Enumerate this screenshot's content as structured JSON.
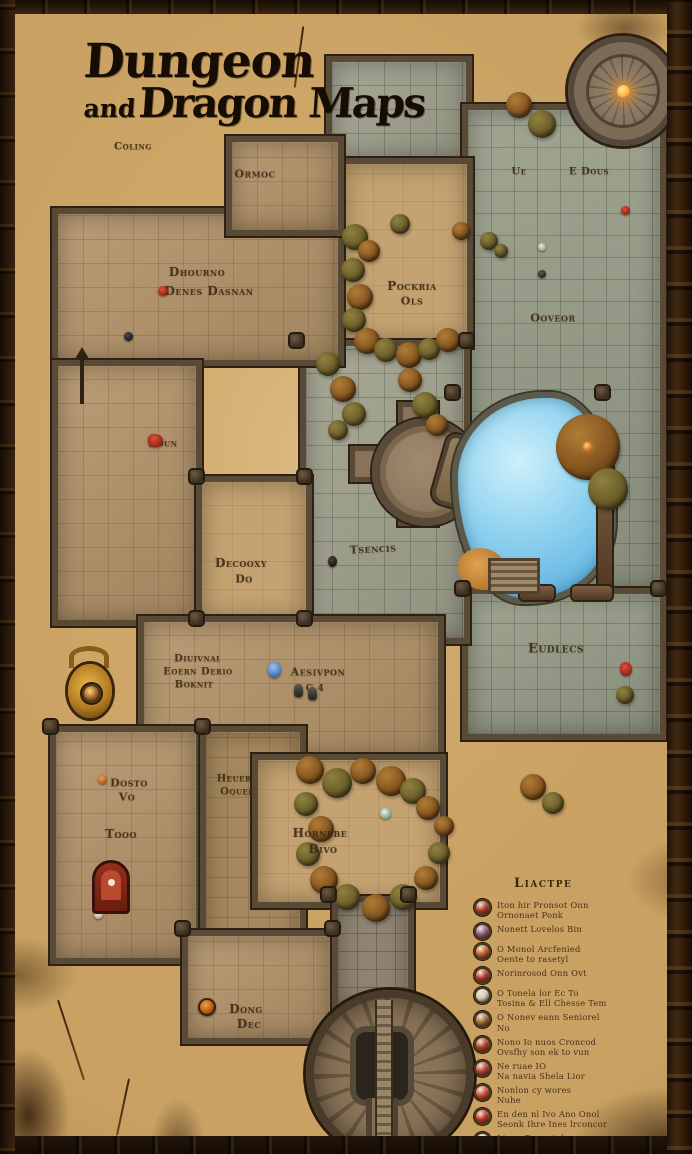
{
  "title": {
    "line1": "Dungeon",
    "line2_prefix": "and",
    "line2_rest": "Dragon Maps"
  },
  "labels": {
    "coling": "Coling",
    "ormoc": "Ormoc",
    "dhourno": "Dhourno",
    "denes_dasnan": "Denes Dasnan",
    "pockria": "Pockria",
    "pockria2": "Ols",
    "ue": "Ue",
    "e_dous": "E Dous",
    "ooveor": "Ooveor",
    "boun": "Boun",
    "tsencis": "Tsencis",
    "decooxy": "Decooxy",
    "decooxy2": "Do",
    "eudlecs": "Eudlecs",
    "diuivnai": "Diuivnai",
    "eoernberio": "Eoern Derio",
    "boknit": "Boknit",
    "aesivpon": "Aesivpon",
    "g4": "G 4",
    "heuer": "Heuer",
    "oquel": "Oquel",
    "dosto": "Dosto",
    "vo": "Vo",
    "tooo": "Tooo",
    "hornebe": "Hornebe",
    "bivo": "Bivo",
    "dong": "Dong",
    "dec": "Dec"
  },
  "legend": {
    "title": "Liactpe",
    "items": [
      {
        "color": "#b03a28",
        "lines": [
          "Iton hir Pronsot Onn",
          "Ornonaet Ponk"
        ]
      },
      {
        "color": "#8a5a78",
        "lines": [
          "Nonett Lovelos Bin"
        ]
      },
      {
        "color": "#c25a2a",
        "lines": [
          "O Monol Arcfenied",
          "Oente to rasetyl"
        ]
      },
      {
        "color": "#b03028",
        "lines": [
          "Norinrosod Onn Ovt"
        ]
      },
      {
        "color": "#cfc8b8",
        "lines": [
          "O Tonela lor Ec To",
          "Tosina & Ell Chesse Tem"
        ]
      },
      {
        "color": "#a06a30",
        "lines": [
          "O Nonev eann Seniorel",
          "No"
        ]
      },
      {
        "color": "#b03a28",
        "lines": [
          "Nono Io nuos Croncod",
          "Ovsfhy son ek to vun"
        ]
      },
      {
        "color": "#b84030",
        "lines": [
          "Ne ruae IO",
          "Na navia Shela Lior"
        ]
      },
      {
        "color": "#d04a30",
        "lines": [
          "Nonlon cy wores",
          "Nuhe"
        ]
      },
      {
        "color": "#c03020",
        "lines": [
          "En den nl Ivo Ano Onol",
          "Seonk Ihre Ines lrconcor"
        ]
      },
      {
        "color": "#c8c0ae",
        "lines": [
          "Linne Danest den",
          "Nonene hero, ln s Lodon"
        ]
      },
      {
        "color": "#8e8878",
        "lines": [
          "Obonoe celr Iostindybuo"
        ]
      }
    ]
  },
  "palette": {
    "parchment": "#cfa768",
    "stone_gray": "#a2a28f",
    "stone_tan": "#b4946a",
    "wall": "#594a36",
    "water": "#7fcbec",
    "title_ink": "#150c04",
    "label_ink": "#3b2a14",
    "frame": "#2a1809"
  },
  "icons": {
    "tower_beacon": "#ffb340",
    "shrine": "#8a2418",
    "amulet": "#c8942a",
    "marker_red": "#b8342a",
    "marker_blue": "#5b8fd4",
    "marker_orange": "#cf7a2e",
    "marker_white": "#e8e2d2"
  }
}
